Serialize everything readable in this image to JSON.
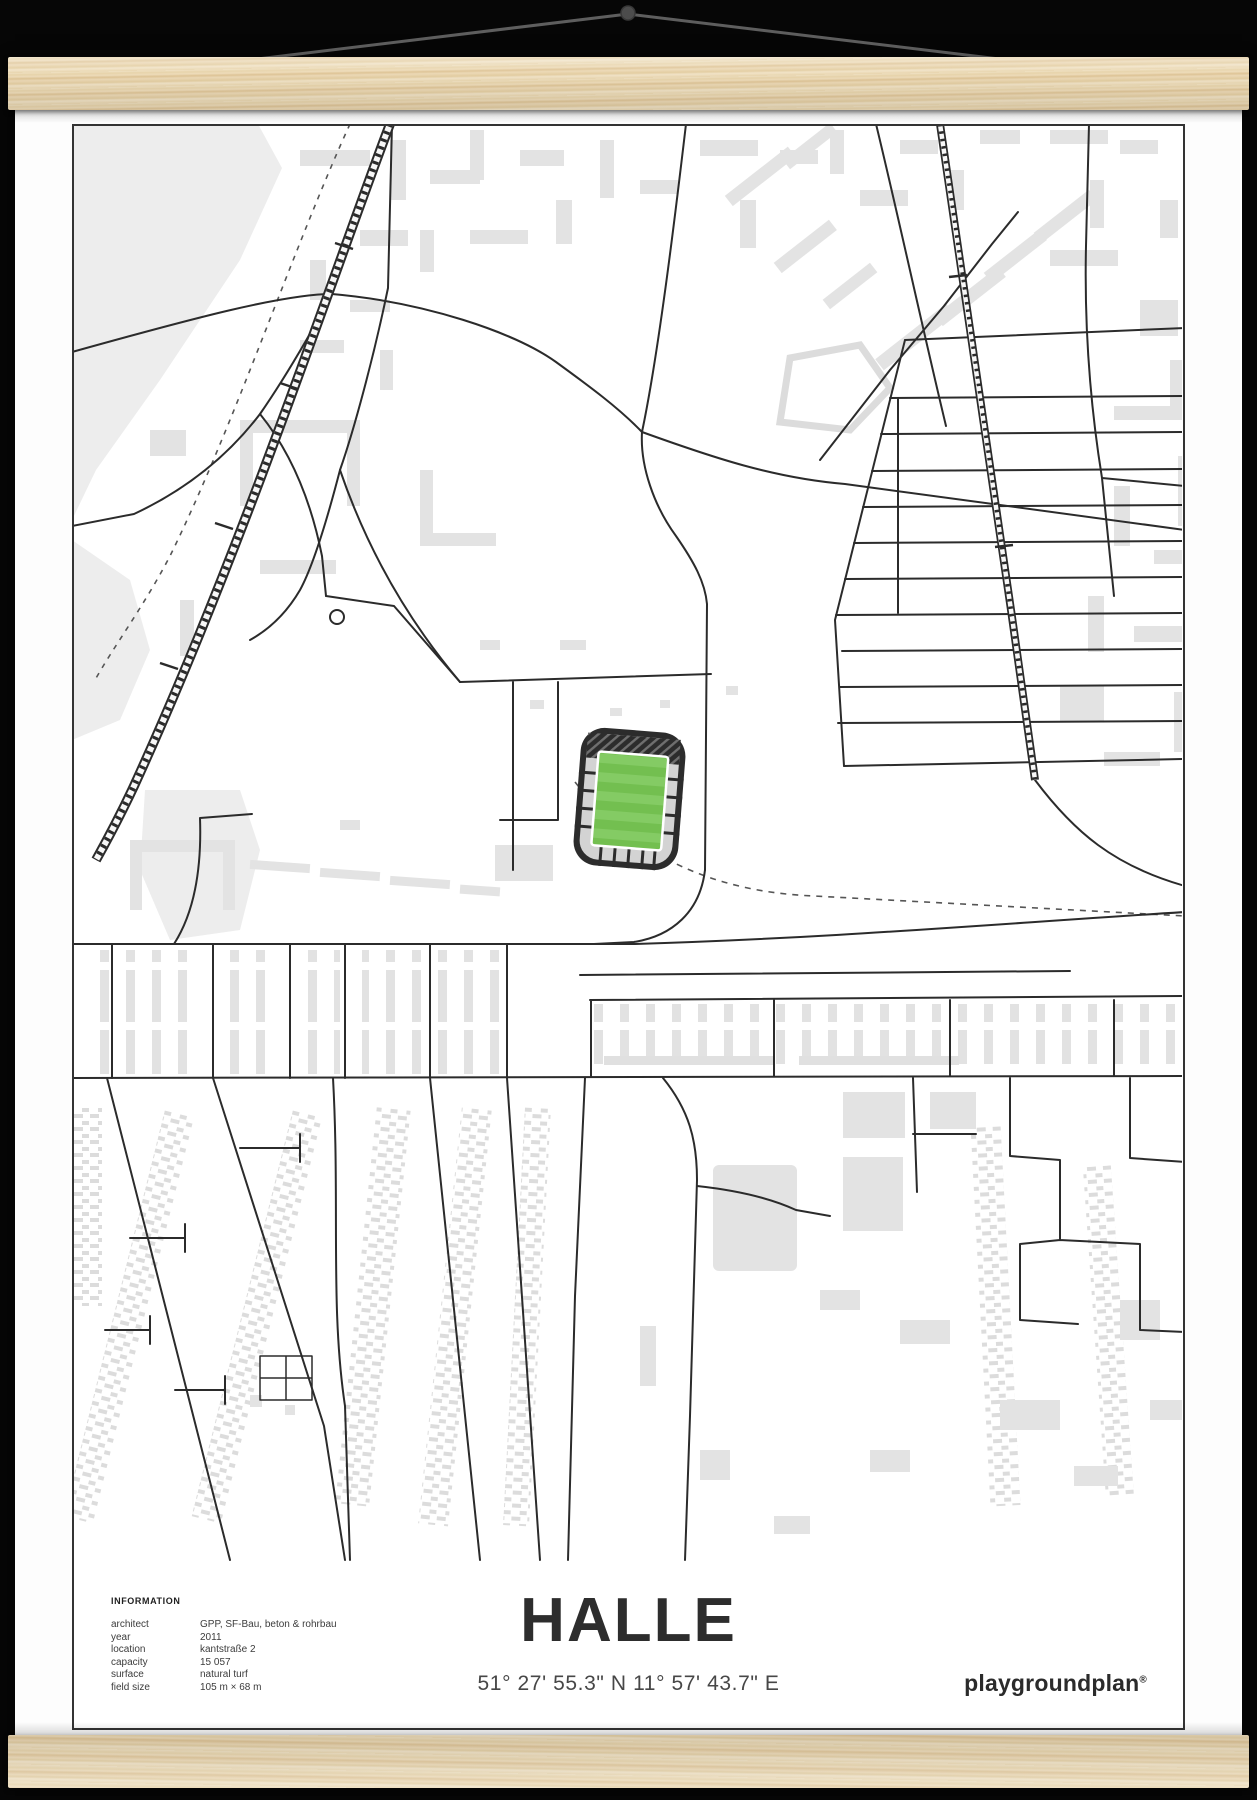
{
  "poster": {
    "title": "HALLE",
    "coordinates": "51° 27' 55.3\" N 11° 57' 43.7\" E",
    "brand": "playgroundplan",
    "brand_mark": "®",
    "information": {
      "heading": "INFORMATION",
      "rows": [
        {
          "label": "architect",
          "value": "GPP, SF-Bau, beton & rohrbau"
        },
        {
          "label": "year",
          "value": "2011"
        },
        {
          "label": "location",
          "value": "kantstraße 2"
        },
        {
          "label": "capacity",
          "value": "15 057"
        },
        {
          "label": "surface",
          "value": "natural turf"
        },
        {
          "label": "field size",
          "value": "105 m × 68 m"
        }
      ]
    }
  },
  "hanger": {
    "background_color": "#060606",
    "wood_color": "#ead8b4",
    "wood_grain_color": "#dfc597",
    "string_color": "#5e5e5e",
    "nail_color": "#4c4c4c"
  },
  "map_palette": {
    "frame_color": "#333333",
    "street_color": "#2b2b2b",
    "building_color": "#e3e3e3",
    "park_color": "#ededed",
    "dashed_path_color": "#555555",
    "stadium_stand_color": "#2c2c2c",
    "stadium_section_color": "#d3d3d3",
    "pitch_green": "#73bf50",
    "pitch_green_light": "#84cb64",
    "pitch_line_color": "#ffffff"
  }
}
